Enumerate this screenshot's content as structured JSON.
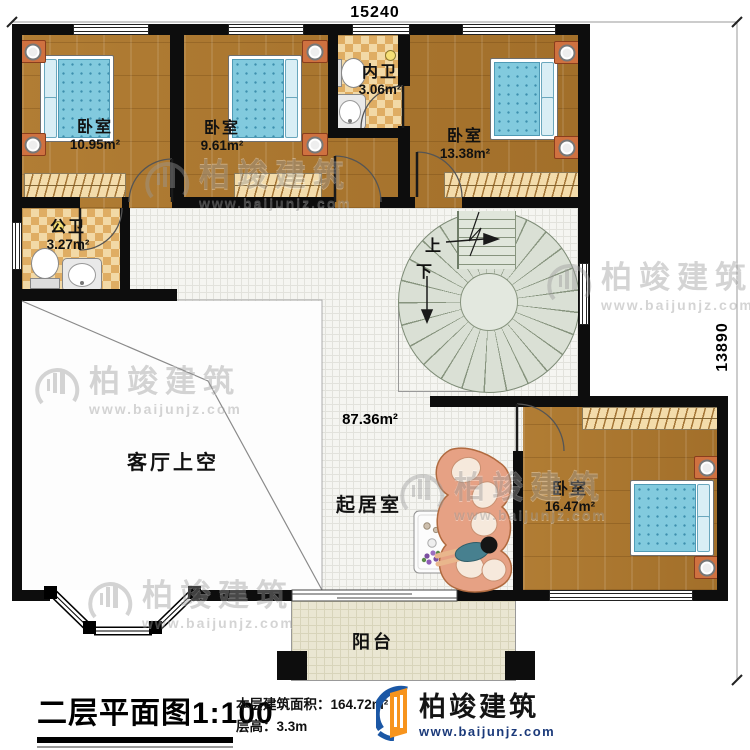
{
  "dimensions": {
    "width": "15240",
    "depth": "13890"
  },
  "rooms": [
    {
      "name": "卧室",
      "area": "10.95m²"
    },
    {
      "name": "卧室",
      "area": "9.61m²"
    },
    {
      "name": "内卫",
      "area": "3.06m²"
    },
    {
      "name": "卧室",
      "area": "13.38m²"
    },
    {
      "name": "公卫",
      "area": "3.27m²"
    },
    {
      "name": "客厅上空"
    },
    {
      "name": "起居室",
      "area": "87.36m²"
    },
    {
      "name": "卧室",
      "area": "16.47m²"
    },
    {
      "name": "阳台"
    }
  ],
  "stairs": {
    "up_label": "上",
    "down_label": "下"
  },
  "footer": {
    "title": "二层平面图",
    "scale": "1:100",
    "area_label": "本层建筑面积：",
    "area_value": "164.72m²",
    "floor_height_label": "层高：",
    "floor_height_value": "3.3m"
  },
  "brand": {
    "name": "柏竣建筑",
    "website": "www.baijunjz.com"
  }
}
